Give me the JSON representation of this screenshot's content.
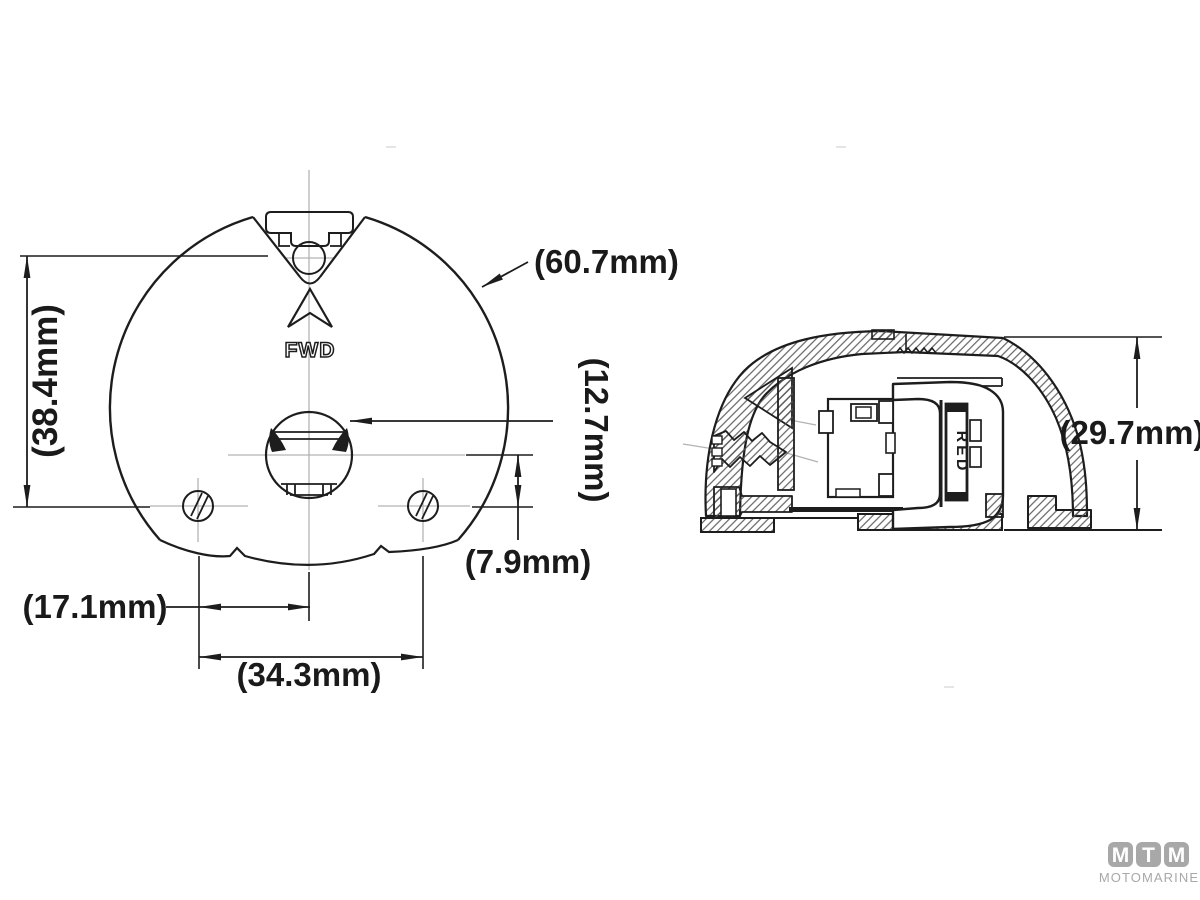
{
  "diagram": {
    "front_view": {
      "fwd_label": "FWD",
      "dim_outer_diameter": "(60.7mm)",
      "dim_vertical_height": "(38.4mm)",
      "dim_center_hole": "(12.7mm)",
      "dim_hole_offset": "(7.9mm)",
      "dim_screw_to_center": "(17.1mm)",
      "dim_screw_spacing": "(34.3mm)"
    },
    "side_view": {
      "lens_label": "RED",
      "dim_height": "(29.7mm)"
    },
    "logo": {
      "letters": [
        "M",
        "T",
        "M"
      ],
      "name": "MOTOMARINE",
      "color": "#a8a8a8"
    },
    "colors": {
      "line": "#1d1d1d",
      "centerline": "#b3b3b3",
      "background": "#ffffff"
    }
  }
}
